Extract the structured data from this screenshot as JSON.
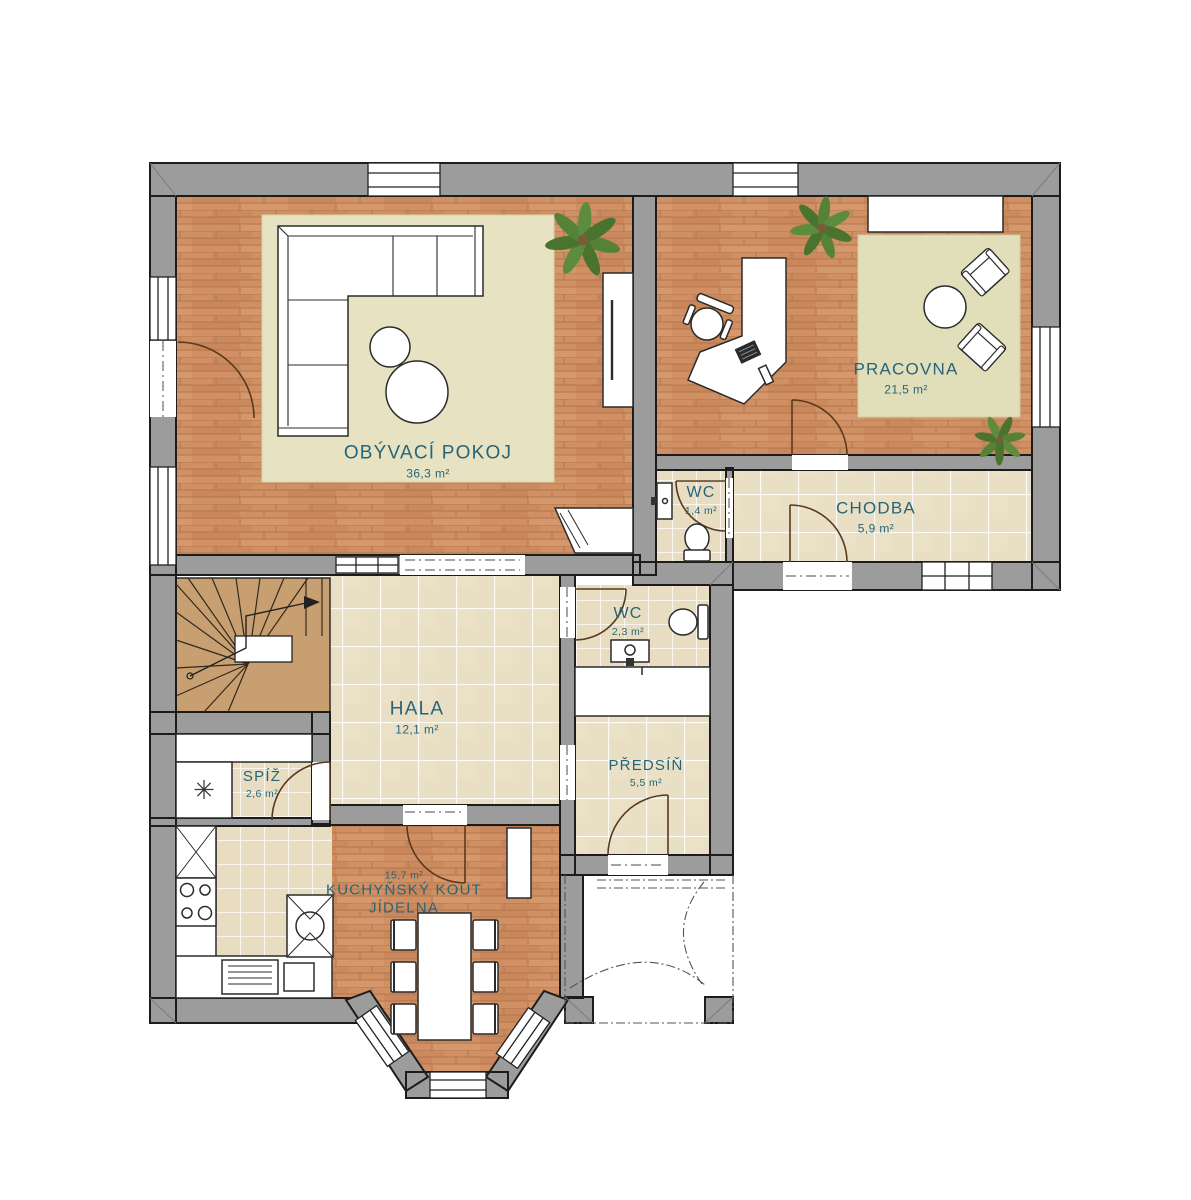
{
  "colors": {
    "label_text": "#266579",
    "wall_gray": "#9c9c9c",
    "wood_floor": "#d09063",
    "tile_floor": "#e9dfc4",
    "rug": "#e7e3c2",
    "stair_wood": "#c79f70",
    "plant_green": "#568238",
    "door_arc": "#5a3a1e"
  },
  "icons": {
    "freezer_snowflake": "✳"
  },
  "rooms": {
    "obyvaci_pokoj": {
      "label": "OBÝVACÍ POKOJ",
      "area": "36,3 m²"
    },
    "pracovna": {
      "label": "PRACOVNA",
      "area": "21,5 m²"
    },
    "wc_horni": {
      "label": "WC",
      "area": "1,4 m²"
    },
    "chodba": {
      "label": "CHODBA",
      "area": "5,9 m²"
    },
    "wc_prizemi": {
      "label": "WC",
      "area": "2,3 m²"
    },
    "hala": {
      "label": "HALA",
      "area": "12,1 m²"
    },
    "predsin": {
      "label": "PŘEDSÍŇ",
      "area": "5,5 m²"
    },
    "spiz": {
      "label": "SPÍŽ",
      "area": "2,6 m²"
    },
    "kuchynsky_kout": {
      "label": "KUCHYŇSKÝ KOUT",
      "label2": "JÍDELNA",
      "area": "15,7 m²"
    }
  }
}
